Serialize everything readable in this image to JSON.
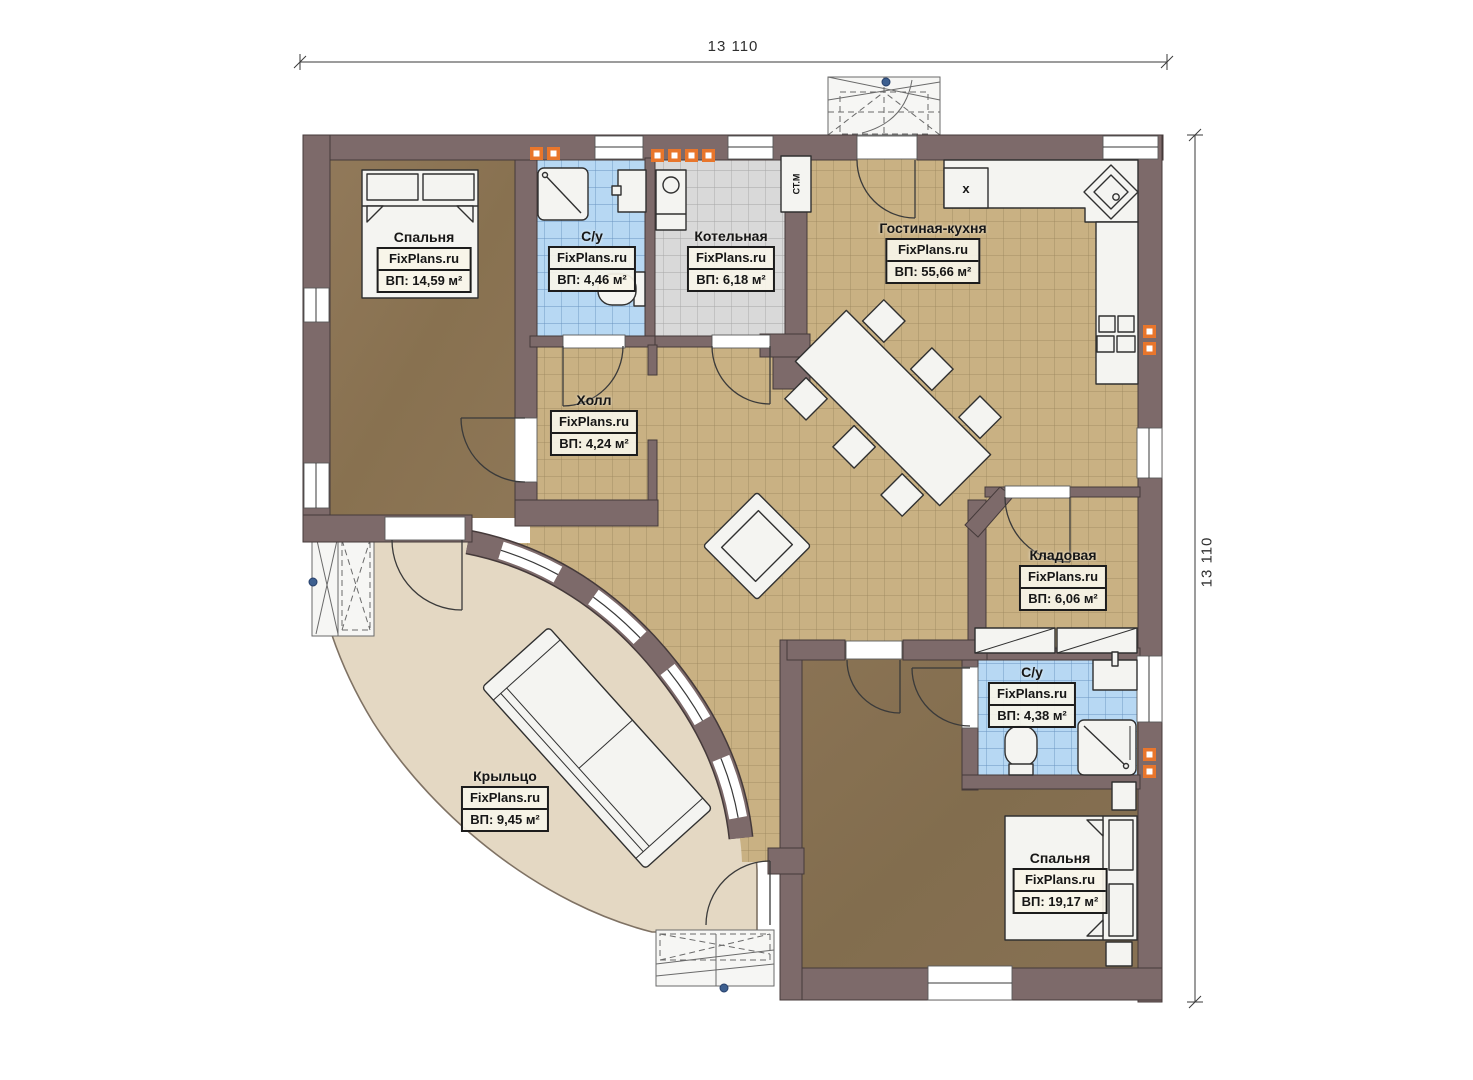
{
  "dimensions": {
    "top": "13 110",
    "right": "13 110"
  },
  "rooms": [
    {
      "id": "bedroom-1",
      "name": "Спальня",
      "brand": "FixPlans.ru",
      "area": "ВП: 14,59 м²"
    },
    {
      "id": "bathroom-1",
      "name": "С/у",
      "brand": "FixPlans.ru",
      "area": "ВП: 4,46 м²"
    },
    {
      "id": "boiler-room",
      "name": "Котельная",
      "brand": "FixPlans.ru",
      "area": "ВП: 6,18 м²"
    },
    {
      "id": "living-kitchen",
      "name": "Гостиная-кухня",
      "brand": "FixPlans.ru",
      "area": "ВП: 55,66 м²"
    },
    {
      "id": "hall",
      "name": "Холл",
      "brand": "FixPlans.ru",
      "area": "ВП: 4,24 м²"
    },
    {
      "id": "storage",
      "name": "Кладовая",
      "brand": "FixPlans.ru",
      "area": "ВП: 6,06 м²"
    },
    {
      "id": "bathroom-2",
      "name": "С/у",
      "brand": "FixPlans.ru",
      "area": "ВП: 4,38 м²"
    },
    {
      "id": "bedroom-2",
      "name": "Спальня",
      "brand": "FixPlans.ru",
      "area": "ВП: 19,17 м²"
    },
    {
      "id": "porch",
      "name": "Крыльцо",
      "brand": "FixPlans.ru",
      "area": "ВП: 9,45 м²"
    }
  ],
  "markers": {
    "washing_machine": "СТ.М",
    "kitchen_appliance": "x"
  },
  "colors": {
    "wall": "#7d6a6a",
    "floor_tile_tan": "#c9b183",
    "floor_tile_blue": "#b7d8f3",
    "floor_tile_gray": "#d9d9d9",
    "floor_bedroom": "#8c7554",
    "porch_beige": "#e4d8c3",
    "vent_orange": "#e8762c"
  }
}
